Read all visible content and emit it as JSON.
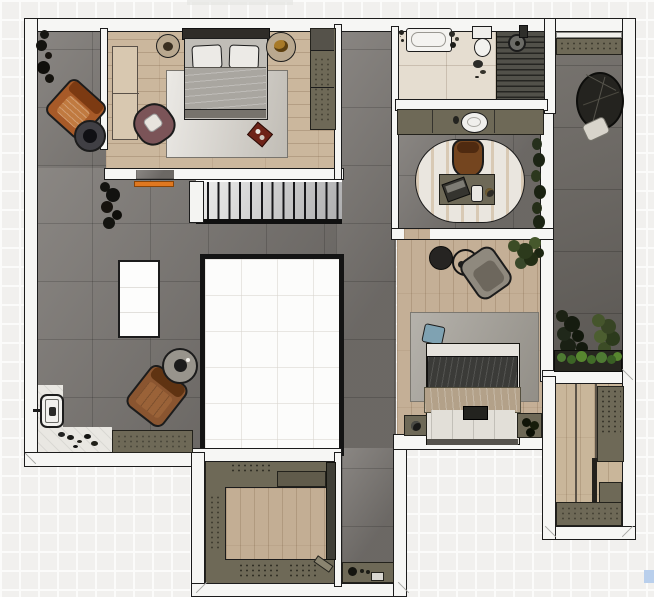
{
  "meta": {
    "view": "apartment floor plan, top-down rendered view",
    "canvas_width_px": 654,
    "canvas_height_px": 597,
    "visible_text": "none"
  },
  "palette": {
    "wall_fill": "#f6f6f4",
    "wall_line": "#1c1c1c",
    "concrete": "#7d7975",
    "wood_light": "#cbb79d",
    "wood_mid": "#c4af96",
    "tile_beige": "#e5ddd0",
    "cabinet_olive": "#6e6957",
    "shower_slats": "#52514a",
    "marble": "#e9e7e2",
    "accent_orange": "#e07820",
    "artifact_blue": "#b9cfec"
  },
  "rooms": {
    "terrace_left": {
      "name": "left terrace (concrete)"
    },
    "living": {
      "name": "open living area (concrete)"
    },
    "corridor": {
      "name": "corridor (concrete)"
    },
    "bedroom1": {
      "name": "master bedroom (wood floor)"
    },
    "bathroom": {
      "name": "bathroom (beige tile)"
    },
    "shower": {
      "name": "shower deck (dark slats)"
    },
    "vanity": {
      "name": "vanity counter"
    },
    "study": {
      "name": "study nook"
    },
    "bedroom2": {
      "name": "second bedroom (wood floor)"
    },
    "terrace_right": {
      "name": "right terrace (concrete)"
    },
    "closet": {
      "name": "walk-in closet / pantry"
    },
    "kitchen": {
      "name": "kitchen (U-shaped counters)"
    },
    "hallway": {
      "name": "rear hallway"
    },
    "entry": {
      "name": "entry nook (marble)"
    },
    "stairs": {
      "name": "staircase"
    },
    "void": {
      "name": "open stairwell void"
    }
  },
  "furniture": {
    "bed1": "double bed with two pillows",
    "rug1": "light area rug",
    "bench1": "low bench / dresser",
    "wardrobe1": "built-in wardrobe",
    "nightstand1l": "round nightstand",
    "nightstand1r": "round nightstand with decor",
    "armchair_mauve": "mauve armchair",
    "tray_red": "red tray",
    "doormat": "orange doormat",
    "door_leaf": "open door leaf",
    "plant_top": "tall plant",
    "armchair_orange": "orange lounge chair",
    "side_table_dark": "dark round side table with plant",
    "plant_mid": "floor plant",
    "dining_table": "white table",
    "armchair_brown": "brown leather armchair",
    "side_table_gray": "round side table with mug",
    "entry_door": "entrance door unit",
    "shoes": "scattered shoes",
    "shoe_cabinet": "shoe cabinet",
    "bathtub": "bathtub",
    "toilet": "toilet",
    "shower_head": "shower drain / head",
    "vanity_sink": "round wash basin",
    "desk": "writing desk",
    "desk_chair": "brown desk chair",
    "laptop": "laptop",
    "cup": "white cup",
    "oval_rug": "striped oval rug",
    "window_plants": "window-side plants",
    "bed2": "double bed with dark duvet and beige throw",
    "rug2": "gray area rug",
    "pillow_blue": "blue cushion",
    "armchair_gray": "gray armchair",
    "side_tables2": "round nesting side tables",
    "plant2": "potted plant",
    "nightstand2l": "nightstand",
    "nightstand2r": "nightstand with plant",
    "hanging_chair": "hanging egg chair",
    "shelf_bench": "terrace storage bench",
    "planter": "planter box with shrubs",
    "terrace_plants": "terrace plants",
    "closet_cabinets": "closet cabinet run",
    "kitchen_island_floor": "kitchen wood floor inset",
    "cutting_board": "cutting board",
    "hall_console": "console with kettle and cups"
  },
  "artifacts": {
    "selection_square": "small blue square at bottom-right edge"
  }
}
